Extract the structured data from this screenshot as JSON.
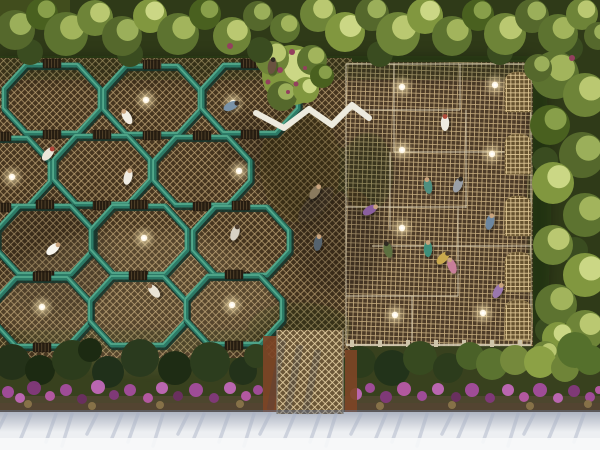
{
  "scene": {
    "palette": {
      "ground": "#38411e",
      "band_dark": "#2f3a18",
      "corner_light": "#46521f",
      "lattice_dark_gap": "#46351f",
      "lattice_dark_line": "#b49a6e",
      "grid_gap": "#4e3c28",
      "grid_line": "#c2a97c",
      "ramp_gap": "#6a5637",
      "ramp_line": "#e2cda0",
      "vault_gap": "#66522f",
      "vault_line": "#e0c896",
      "teal": "#2c7a66",
      "teal_hi": "#53a98c",
      "teal_dark": "#16352c",
      "seam": "#d9ceb4",
      "beam": "#d6cdb6",
      "post": "#cfc5aa",
      "orb_core": "#fff8e8",
      "walkway": "#eceade",
      "slat_bg": "#261d11",
      "slat_line": "#77613f",
      "underbrush": "#5f4a3c",
      "underbrush2": "#5a4434",
      "rust": "#7e4526",
      "sidewalk": "#edeff2",
      "sidewalk_bright": "#f7f8fa",
      "streak": "#a7b0c4",
      "shadow_warm": "#ffe8b5",
      "blossom": "#93405e",
      "tree_bases": [
        "#5d7330",
        "#49601f",
        "#6e8438",
        "#55682c",
        "#81973f"
      ],
      "tree_his": [
        "#aabb62",
        "#8fa64f",
        "#c2cf78",
        "#a3b75f",
        "#d3de8d"
      ],
      "tree_filler": "#3a4c20",
      "flower_colors": [
        "#a44d9e",
        "#c168b8",
        "#83397c",
        "#b85aa6",
        "#6b2f62",
        "#8a744a"
      ]
    },
    "decks": {
      "hex": [
        0,
        58,
        352,
        300
      ],
      "grid": [
        346,
        62,
        187,
        284
      ]
    },
    "hex_cells": [
      [
        52,
        99
      ],
      [
        152,
        100
      ],
      [
        250,
        99
      ],
      [
        2,
        172
      ],
      [
        102,
        170
      ],
      [
        202,
        171
      ],
      [
        45,
        240
      ],
      [
        139,
        240
      ],
      [
        241,
        241
      ],
      [
        42,
        312
      ],
      [
        138,
        311
      ],
      [
        234,
        310
      ]
    ],
    "lights": [
      [
        146,
        100
      ],
      [
        233,
        103
      ],
      [
        239,
        171
      ],
      [
        12,
        177
      ],
      [
        144,
        238
      ],
      [
        42,
        307
      ],
      [
        232,
        305
      ],
      [
        402,
        87
      ],
      [
        495,
        85
      ],
      [
        402,
        150
      ],
      [
        492,
        154
      ],
      [
        402,
        228
      ],
      [
        395,
        315
      ],
      [
        483,
        313
      ]
    ],
    "people": [
      [
        127,
        117,
        -30,
        "#f2eee4",
        "#c9a47e"
      ],
      [
        231,
        106,
        65,
        "#7a93a8",
        "#3a2f26"
      ],
      [
        48,
        154,
        40,
        "#ece7da",
        "#b2443a"
      ],
      [
        128,
        177,
        15,
        "#f0ece2",
        "#c9a47e"
      ],
      [
        154,
        291,
        -40,
        "#e9e4d6",
        "#8a6a4a"
      ],
      [
        53,
        249,
        50,
        "#f7f5ee",
        "#c9a47e"
      ],
      [
        235,
        233,
        20,
        "#d8d2c4",
        "#4a3a2c"
      ],
      [
        445,
        123,
        0,
        "#efece2",
        "#b04a3a"
      ],
      [
        458,
        185,
        25,
        "#9aa0a8",
        "#2f2a22"
      ],
      [
        318,
        243,
        10,
        "#55636e",
        "#c9a47e"
      ],
      [
        388,
        250,
        -15,
        "#5d7040",
        "#2f2a22"
      ],
      [
        498,
        291,
        30,
        "#9a77ae",
        "#c9a47e"
      ],
      [
        428,
        249,
        0,
        "#3f8f7a",
        "#c9a47e"
      ],
      [
        443,
        258,
        45,
        "#c9a94d",
        "#4a3a2c"
      ],
      [
        452,
        266,
        -20,
        "#c77f9a",
        "#c9a47e"
      ],
      [
        370,
        210,
        60,
        "#8a5f9e",
        "#c9a47e"
      ],
      [
        272,
        66,
        10,
        "#6a5240",
        "#2f2a22"
      ],
      [
        315,
        192,
        35,
        "#8a7a5e",
        "#c9a47e"
      ],
      [
        428,
        186,
        -10,
        "#4f8f80",
        "#c9a47e"
      ],
      [
        490,
        222,
        15,
        "#6d87a0",
        "#c9a47e"
      ]
    ],
    "trees_top": [
      [
        15,
        30,
        20,
        3
      ],
      [
        42,
        14,
        16,
        1
      ],
      [
        66,
        34,
        22,
        0
      ],
      [
        95,
        18,
        18,
        2
      ],
      [
        122,
        36,
        20,
        3
      ],
      [
        150,
        16,
        17,
        4
      ],
      [
        178,
        34,
        21,
        0
      ],
      [
        205,
        14,
        16,
        1
      ],
      [
        232,
        36,
        19,
        2
      ],
      [
        258,
        16,
        15,
        3
      ],
      [
        285,
        28,
        15,
        0
      ],
      [
        318,
        14,
        18,
        2
      ],
      [
        345,
        32,
        20,
        4
      ],
      [
        372,
        14,
        17,
        3
      ],
      [
        398,
        34,
        22,
        2
      ],
      [
        425,
        16,
        18,
        4
      ],
      [
        452,
        36,
        20,
        0
      ],
      [
        478,
        15,
        16,
        1
      ],
      [
        505,
        34,
        21,
        2
      ],
      [
        532,
        16,
        17,
        3
      ],
      [
        558,
        34,
        20,
        0
      ],
      [
        582,
        14,
        16,
        2
      ],
      [
        598,
        36,
        14,
        3
      ]
    ],
    "trees_right": [
      [
        555,
        75,
        24,
        0
      ],
      [
        585,
        95,
        22,
        2
      ],
      [
        550,
        125,
        20,
        1
      ],
      [
        582,
        155,
        23,
        3
      ],
      [
        553,
        183,
        21,
        4
      ],
      [
        585,
        215,
        22,
        0
      ],
      [
        553,
        245,
        20,
        2
      ],
      [
        585,
        275,
        22,
        4
      ],
      [
        556,
        305,
        21,
        0
      ],
      [
        585,
        330,
        20,
        2
      ],
      [
        558,
        338,
        16,
        4
      ],
      [
        538,
        68,
        14,
        3
      ],
      [
        545,
        355,
        14,
        2
      ]
    ],
    "tree_fillers": [
      [
        30,
        52
      ],
      [
        130,
        54
      ],
      [
        260,
        50
      ],
      [
        380,
        54
      ],
      [
        500,
        52
      ],
      [
        570,
        48
      ],
      [
        545,
        160
      ],
      [
        575,
        250
      ],
      [
        548,
        330
      ]
    ],
    "center_tree": {
      "canopy": [
        [
          292,
          75,
          30,
          4
        ],
        [
          272,
          58,
          17,
          2
        ],
        [
          312,
          60,
          15,
          0
        ],
        [
          282,
          96,
          15,
          3
        ],
        [
          306,
          90,
          13,
          4
        ],
        [
          322,
          76,
          12,
          1
        ]
      ],
      "blossoms": [
        [
          280,
          70,
          3
        ],
        [
          296,
          84,
          2.5
        ],
        [
          268,
          82,
          2.5
        ],
        [
          305,
          68,
          2
        ],
        [
          288,
          92,
          2
        ]
      ]
    },
    "blossom_accents": [
      [
        230,
        46,
        3
      ],
      [
        292,
        52,
        3
      ],
      [
        572,
        58,
        3
      ]
    ],
    "shadows": [
      [
        "r",
        0,
        56,
        534,
        24,
        0.28
      ],
      [
        "e",
        300,
        165,
        40,
        58,
        0.32
      ],
      [
        "e",
        338,
        240,
        46,
        55,
        0.2
      ],
      [
        "e",
        368,
        172,
        26,
        40,
        0.26
      ],
      [
        "e",
        55,
        255,
        55,
        62,
        0.16
      ],
      [
        "e",
        300,
        328,
        52,
        26,
        0.22
      ],
      [
        "e",
        539,
        204,
        12,
        140,
        0.3
      ],
      [
        "e",
        250,
        142,
        28,
        34,
        0.16
      ],
      [
        "r",
        0,
        330,
        260,
        22,
        0.18
      ]
    ],
    "seams": [
      "M346 64 V345",
      "M531 64 V344",
      "M346 64 H531",
      "M394 64 V152",
      "M390 152 V230",
      "M460 64 V110",
      "M466 110 V208",
      "M458 208 V296",
      "M346 110 H460",
      "M394 152 H531",
      "M346 207 H466",
      "M372 246 H531",
      "M346 296 H458",
      "M412 296 V344"
    ],
    "vaults": {
      "x0": 505,
      "x1": 531,
      "h": 40,
      "ys": [
        72,
        134,
        196,
        252,
        300
      ]
    },
    "beam": {
      "line": [
        346,
        345,
        531,
        345
      ],
      "post_y": 340,
      "post_step": 28
    },
    "walkway_points": "256,113 284,128 309,109 332,125 352,105 369,118",
    "bushes": [
      [
        12,
        362,
        18,
        "#243219"
      ],
      [
        40,
        370,
        15,
        "#1c2a12"
      ],
      [
        72,
        360,
        20,
        "#2c3c1c"
      ],
      [
        108,
        372,
        16,
        "#20301a"
      ],
      [
        140,
        358,
        19,
        "#2a3a1e"
      ],
      [
        175,
        368,
        17,
        "#1e2c14"
      ],
      [
        210,
        362,
        20,
        "#2c3d1e"
      ],
      [
        243,
        371,
        14,
        "#23321a"
      ],
      [
        256,
        356,
        12,
        "#31411f"
      ],
      [
        90,
        350,
        12,
        "#1c2a12"
      ],
      [
        360,
        362,
        16,
        "#2c3c1c"
      ],
      [
        392,
        368,
        18,
        "#22331a"
      ],
      [
        420,
        358,
        17,
        "#374a20"
      ],
      [
        448,
        368,
        15,
        "#2c3c1c"
      ],
      [
        470,
        356,
        14,
        "#4a6128"
      ],
      [
        492,
        364,
        16,
        "#5b7330"
      ],
      [
        515,
        360,
        15,
        "#75893c"
      ],
      [
        540,
        362,
        16,
        "#8ca145"
      ],
      [
        565,
        368,
        14,
        "#6f8438"
      ],
      [
        590,
        360,
        15,
        "#55702c"
      ],
      [
        575,
        350,
        18,
        "#55702c"
      ]
    ],
    "flowers": [
      [
        8,
        392,
        6,
        0
      ],
      [
        20,
        398,
        5,
        1
      ],
      [
        34,
        388,
        7,
        2
      ],
      [
        50,
        396,
        5,
        3
      ],
      [
        66,
        390,
        6,
        0
      ],
      [
        82,
        399,
        5,
        4
      ],
      [
        98,
        387,
        7,
        1
      ],
      [
        114,
        395,
        5,
        2
      ],
      [
        130,
        390,
        6,
        0
      ],
      [
        148,
        398,
        5,
        3
      ],
      [
        162,
        388,
        6,
        1
      ],
      [
        178,
        396,
        5,
        4
      ],
      [
        196,
        390,
        7,
        0
      ],
      [
        214,
        398,
        5,
        2
      ],
      [
        230,
        388,
        6,
        1
      ],
      [
        246,
        396,
        5,
        3
      ],
      [
        258,
        390,
        5,
        0
      ],
      [
        356,
        394,
        6,
        1
      ],
      [
        370,
        388,
        5,
        0
      ],
      [
        386,
        397,
        6,
        2
      ],
      [
        404,
        389,
        7,
        3
      ],
      [
        422,
        396,
        5,
        0
      ],
      [
        438,
        389,
        6,
        1
      ],
      [
        456,
        397,
        5,
        4
      ],
      [
        472,
        390,
        7,
        0
      ],
      [
        490,
        398,
        5,
        2
      ],
      [
        508,
        390,
        6,
        1
      ],
      [
        524,
        397,
        5,
        3
      ],
      [
        540,
        390,
        7,
        0
      ],
      [
        558,
        398,
        5,
        1
      ],
      [
        574,
        391,
        6,
        2
      ],
      [
        590,
        397,
        5,
        0
      ],
      [
        599,
        390,
        4,
        3
      ],
      [
        28,
        404,
        4,
        5
      ],
      [
        92,
        406,
        4,
        5
      ],
      [
        160,
        405,
        4,
        5
      ],
      [
        240,
        404,
        4,
        5
      ],
      [
        380,
        406,
        4,
        5
      ],
      [
        452,
        405,
        4,
        5
      ],
      [
        530,
        406,
        4,
        5
      ],
      [
        588,
        404,
        4,
        5
      ]
    ],
    "underbrush": [
      [
        0,
        396,
        600,
        16
      ],
      [
        0,
        403,
        600,
        10
      ]
    ],
    "rust_strips": [
      [
        263,
        336,
        14,
        76
      ],
      [
        345,
        350,
        12,
        62
      ]
    ],
    "ramp": [
      277,
      330,
      66,
      84
    ],
    "ramp_shadows": [
      [
        283,
        340,
        270,
        410
      ],
      [
        300,
        345,
        287,
        413
      ],
      [
        318,
        350,
        305,
        414
      ]
    ],
    "sidewalk": {
      "base": [
        0,
        412,
        600,
        38
      ],
      "bright": [
        0,
        438,
        600,
        12
      ],
      "shadow_band": [
        0,
        410,
        600,
        22
      ],
      "streaks": {
        "count": 27,
        "x0": 6,
        "step": 22,
        "y": 414,
        "dx": -10,
        "dy": 20
      }
    }
  }
}
